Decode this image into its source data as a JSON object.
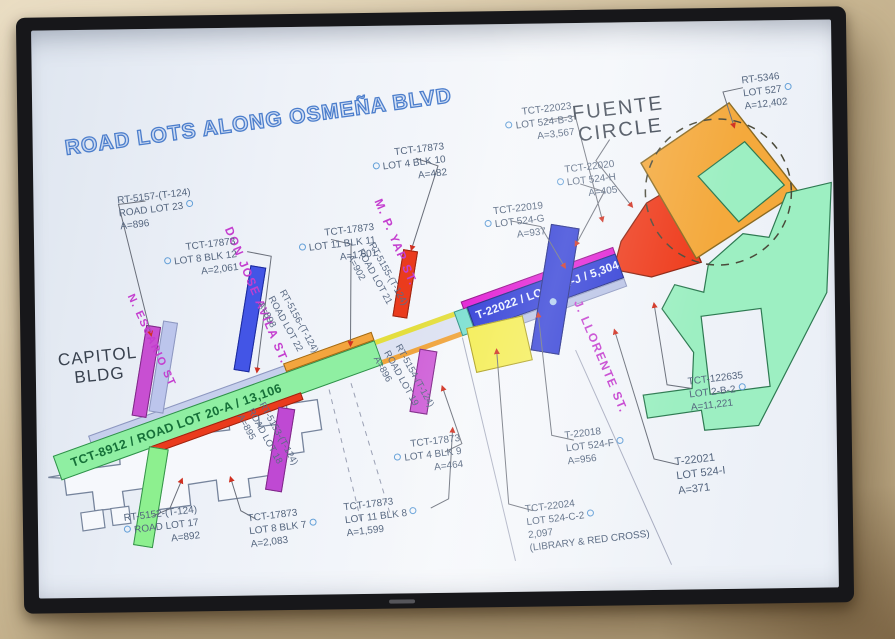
{
  "title": "ROAD LOTS ALONG OSMEÑA BLVD",
  "landmarks": {
    "fuente": {
      "line1": "FUENTE",
      "line2": "CIRCLE"
    },
    "capitol": {
      "line1": "CAPITOL",
      "line2": "BLDG"
    }
  },
  "road": {
    "west_label": "TCT-8912 / ROAD LOT 20-A / 13,106",
    "east_label": "T-22022 / LOT 524-J / 5,304"
  },
  "streets": [
    {
      "name": "N. ESCARIO ST"
    },
    {
      "name": "DON JOSE AVILA ST."
    },
    {
      "name": "M. P. YAP ST."
    },
    {
      "name": "J. LLORENTE ST."
    }
  ],
  "road_lot_callouts": [
    {
      "lines": [
        "RT-5156-(T-124)",
        "ROAD LOT 22",
        "A=898"
      ]
    },
    {
      "lines": [
        "RT-5155-(T-124)",
        "ROAD LOT 21",
        "A=902"
      ]
    },
    {
      "lines": [
        "RT-5154-(T-124)",
        "ROAD LOT 19",
        "A=896"
      ]
    },
    {
      "lines": [
        "RT-5153-(T-124)",
        "ROAD LOT 18",
        "A=895"
      ]
    }
  ],
  "lot_labels": [
    {
      "lines": [
        "RT-5157-(T-124)",
        "ROAD LOT 23",
        "A=896"
      ]
    },
    {
      "lines": [
        "TCT-17873",
        "LOT 8 BLK 12",
        "A=2,061"
      ]
    },
    {
      "lines": [
        "TCT-17873",
        "LOT 11 BLK 11",
        "A=1,601"
      ]
    },
    {
      "lines": [
        "TCT-17873",
        "LOT 4 BLK 10",
        "A=482"
      ]
    },
    {
      "lines": [
        "TCT-22023",
        "LOT 524-B-3",
        "A=3,567"
      ]
    },
    {
      "lines": [
        "TCT-22020",
        "LOT 524-H",
        "A=405"
      ]
    },
    {
      "lines": [
        "TCT-22019",
        "LOT 524-G",
        "A=937"
      ]
    },
    {
      "lines": [
        "RT-5346",
        "LOT 527",
        "A=12,402"
      ]
    },
    {
      "lines": [
        "TCT-122635",
        "LOT 2-B-2",
        "A=11,221"
      ]
    },
    {
      "lines": [
        "T-22018",
        "LOT 524-F",
        "A=956"
      ]
    },
    {
      "lines": [
        "T-22021",
        "LOT 524-I",
        "A=371"
      ]
    },
    {
      "lines": [
        "TCT-22024",
        "LOT 524-C-2",
        "2,097",
        "(LIBRARY & RED CROSS)"
      ]
    },
    {
      "lines": [
        "TCT-17873",
        "LOT 4 BLK 9",
        "A=464"
      ]
    },
    {
      "lines": [
        "TCT-17873",
        "LOT 11 BLK 8",
        "A=1,599"
      ]
    },
    {
      "lines": [
        "TCT-17873",
        "LOT 8 BLK 7",
        "A=2,083"
      ]
    },
    {
      "lines": [
        "RT-5152-(T-124)",
        "ROAD LOT 17",
        "A=892"
      ]
    }
  ],
  "icons": {
    "lot_marker": "circle-outline",
    "next_arrow": "right-arrow"
  },
  "colors": {
    "title_blue": "#4c7ecc",
    "road_green": "#8fefa2",
    "road_blue": "#2f3cd6",
    "road_yellow": "#f4ed52",
    "road_red": "#ea3b1d",
    "road_orange": "#f3a53e",
    "road_magenta": "#e21cd4",
    "street_label_magenta": "#c43ecf",
    "fuente_orange": "#f4a93c",
    "fuente_mint": "#9defc2",
    "label_slate": "#54657e",
    "arrow_blue": "#b5d9ef"
  }
}
